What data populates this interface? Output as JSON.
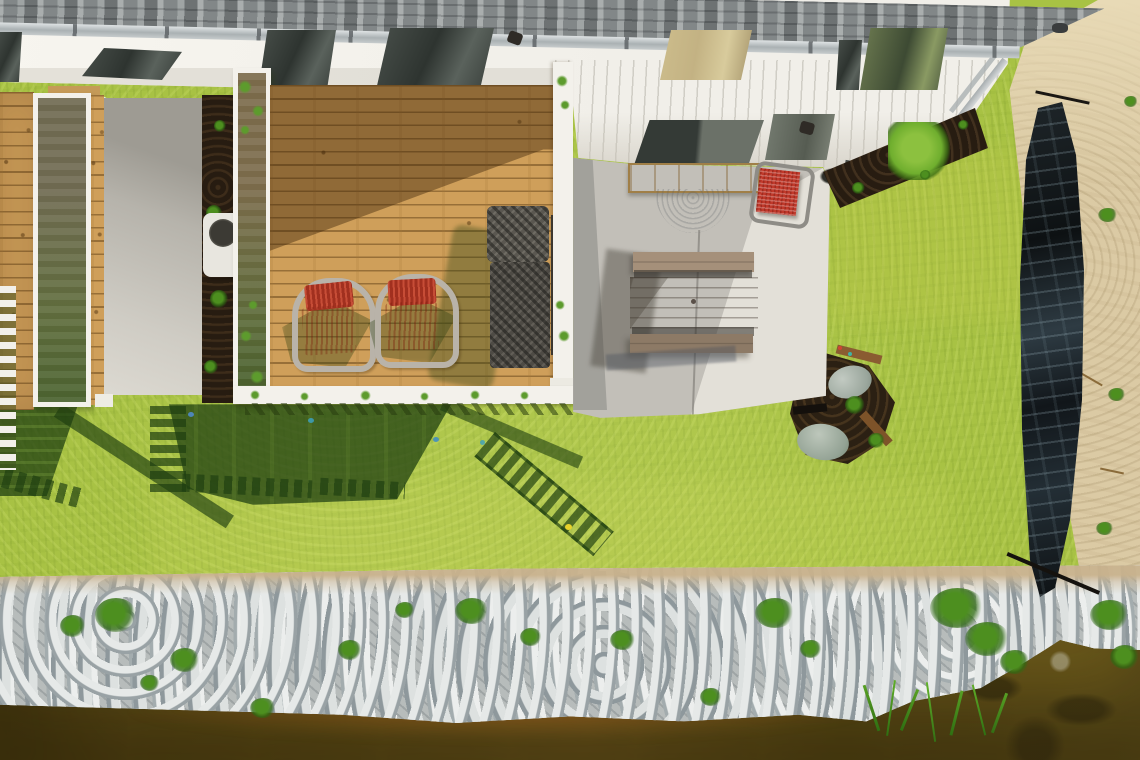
{
  "scene": {
    "type": "aerial-photograph",
    "description": "Top-down drone photo of a townhouse backyard: gray shingle roof edge with gutter along the top, white soffit with skylights and windows, a natural wood deck with two red sling chairs and a dark wicker chaise lounge, white privacy trellises, a concrete patio with a composite picnic table, wooden storage bench, half-round black grill mat and a red bistro chair, a bright green lawn with long railing shadows, a black silt fence beside a sandy strip on the right, and a riprap rock shoreline meeting brown pond water along the bottom.",
    "objects": {
      "roof": {
        "label": "gray shingle roof edge"
      },
      "gutter": {
        "label": "metal gutter"
      },
      "soffit": {
        "label": "white soffit and siding"
      },
      "skylights": {
        "label": "dark skylight windows"
      },
      "amber_window": {
        "label": "window with warm reflection"
      },
      "porch_light": {
        "label": "porch light fixture"
      },
      "left_slab": {
        "label": "neighbor concrete pad"
      },
      "ac_unit": {
        "label": "air-conditioner condenser"
      },
      "mulch_strip": {
        "label": "mulch planting strip"
      },
      "trellis": {
        "label": "white privacy trellis"
      },
      "main_deck": {
        "label": "wood plank deck"
      },
      "red_deck_chairs": {
        "label": "two red sling deck chairs"
      },
      "chaise": {
        "label": "dark wicker chaise lounge"
      },
      "deck_railing": {
        "label": "white deck railing"
      },
      "patio": {
        "label": "concrete patio"
      },
      "storage_bench": {
        "label": "wooden storage bench"
      },
      "grill_mat": {
        "label": "half-round black grill mat"
      },
      "red_bistro_chair": {
        "label": "red mesh bistro chair"
      },
      "picnic_table": {
        "label": "composite picnic table with benches"
      },
      "shrub_bed": {
        "label": "mulch bed with green shrub"
      },
      "stone_feature": {
        "label": "mulch corner with stones and edging"
      },
      "lawn": {
        "label": "green lawn"
      },
      "shadows": {
        "label": "railing and deck shadows on lawn"
      },
      "silt_fence": {
        "label": "black silt fence"
      },
      "sand": {
        "label": "sandy strip"
      },
      "shoreline": {
        "label": "riprap rock shoreline"
      },
      "weeds": {
        "label": "green weeds in rocks"
      },
      "reeds": {
        "label": "grass reeds over water"
      },
      "water": {
        "label": "brown pond water"
      }
    }
  },
  "palette": {
    "roof": "#9a9f9f",
    "gutter": "#c3c9cb",
    "house_white": "#f1efe9",
    "window_dark": "#2e3430",
    "window_amber": "#c3b283",
    "deck_wood": "#cf9f5a",
    "trellis_white": "#f3f1eb",
    "concrete": "#c2bfb8",
    "concrete_bright": "#e9e7df",
    "mulch": "#271c11",
    "grass": "#a8c244",
    "grass_shadow": "#2a5412",
    "sand": "#dbcaa4",
    "rock": "#b7bcbb",
    "water": "#6d5919",
    "silt_fence": "#15191b",
    "chair_red": "#d2492f",
    "table_wood": "#9c8871",
    "chaise_gray": "#4e4b45",
    "shrub_green": "#6fae2e"
  }
}
